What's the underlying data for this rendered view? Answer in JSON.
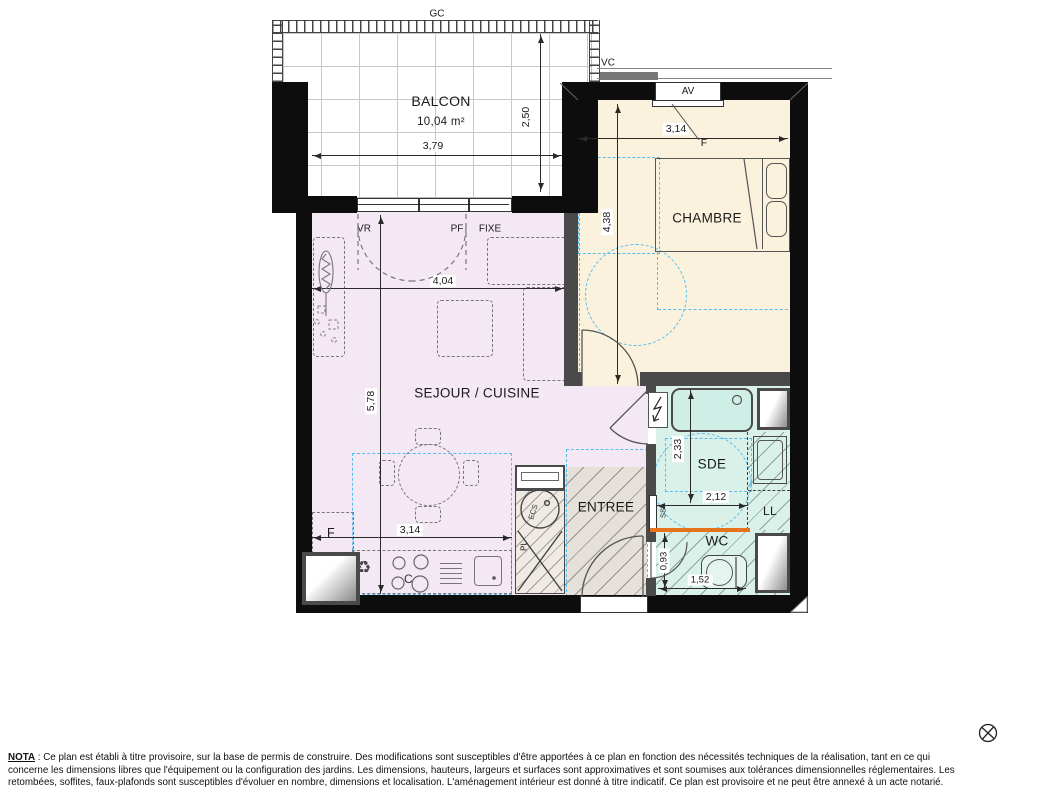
{
  "rooms": {
    "balcon": {
      "name": "BALCON",
      "area": "10,04 m²"
    },
    "chambre": {
      "name": "CHAMBRE"
    },
    "sejour": {
      "name": "SEJOUR / CUISINE"
    },
    "entree": {
      "name": "ENTREE"
    },
    "sde": {
      "name": "SDE"
    },
    "wc": {
      "name": "WC"
    }
  },
  "openings": {
    "gc": "GC",
    "vc": "VC",
    "av": "AV",
    "f_chambre": "F",
    "vr": "VR",
    "pf": "PF",
    "fixe": "FIXE"
  },
  "equipment": {
    "ecs": "ECS",
    "pl": "PL",
    "ll": "LL",
    "ss": "SS",
    "fridge": "F",
    "cooktop": "C"
  },
  "icons": {
    "recycle": "♻",
    "plan_mark": "circle-x"
  },
  "dimensions": {
    "balcon_width": "3,79",
    "balcon_depth": "2,50",
    "chambre_width": "3,14",
    "chambre_depth": "4,38",
    "sejour_width": "4,04",
    "sejour_depth": "5,78",
    "cuisine_width": "3,14",
    "sde_depth": "2,33",
    "sde_width": "2,12",
    "wc_depth": "0,93",
    "wc_width": "1,52"
  },
  "colors": {
    "living": "#f4e8f5",
    "bedroom": "#faf2dc",
    "bathroom": "#d9f1e9",
    "entry": "#e5e0d9",
    "accessibility_blue": "#56bdf0",
    "divider_orange": "#e8731e",
    "wall_black": "#0d0d0d",
    "wall_gray": "#4a4a4a"
  },
  "nota": {
    "title": "NOTA",
    "line1": " : Ce plan est établi à titre provisoire, sur la base de permis de construire. Des modifications sont susceptibles d'être apportées à ce plan en fonction des nécessités techniques de la réalisation, tant en ce qui",
    "line2": "concerne les dimensions libres que l'équipement ou la configuration des jardins. Les dimensions, hauteurs, largeurs et surfaces sont approximatives et sont soumises aux tolérances dimensionnelles réglementaires. Les",
    "line3": "retombées, soffites, faux-plafonds sont susceptibles d'évoluer en nombre, dimensions et localisation. L'aménagement intérieur est donné à titre indicatif. Ce plan est provisoire et ne peut être annexé à un acte notarié."
  }
}
